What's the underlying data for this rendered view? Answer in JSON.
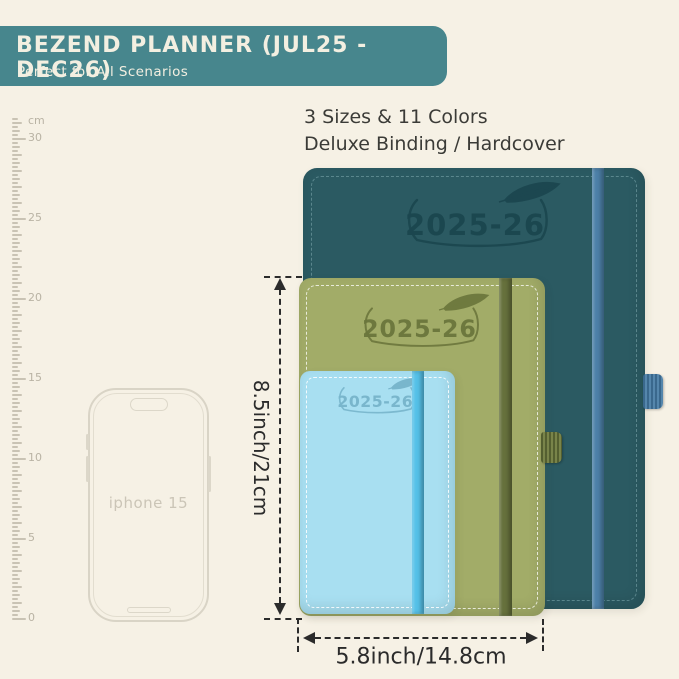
{
  "page_bg": "#F6F1E5",
  "banner": {
    "bg": "#47868D",
    "title": "BEZEND PLANNER (JUL25 - DEC26)",
    "subtitle": "Perfect for All Scenarios"
  },
  "headline": {
    "line1": "3 Sizes & 11 Colors",
    "line2": "Deluxe Binding / Hardcover"
  },
  "ruler": {
    "unit": "cm",
    "max": 30,
    "label_step": 5,
    "labels": [
      "30",
      "25",
      "20",
      "15",
      "10",
      "5",
      "0"
    ]
  },
  "phone": {
    "label": "iphone 15"
  },
  "planners": {
    "large": {
      "year": "2025-26",
      "cover": "#2B5A62",
      "band": "#4D81A8",
      "emboss": "#1B464F"
    },
    "medium": {
      "year": "2025-26",
      "cover": "#A2AC68",
      "band": "#66713C",
      "emboss": "#6B763C"
    },
    "small": {
      "year": "2025-26",
      "cover": "#A8DFF1",
      "band": "#55C1E8",
      "emboss": "#79B6CC"
    }
  },
  "dimensions": {
    "height_label": "8.5inch/21cm",
    "width_label": "5.8inch/14.8cm"
  }
}
